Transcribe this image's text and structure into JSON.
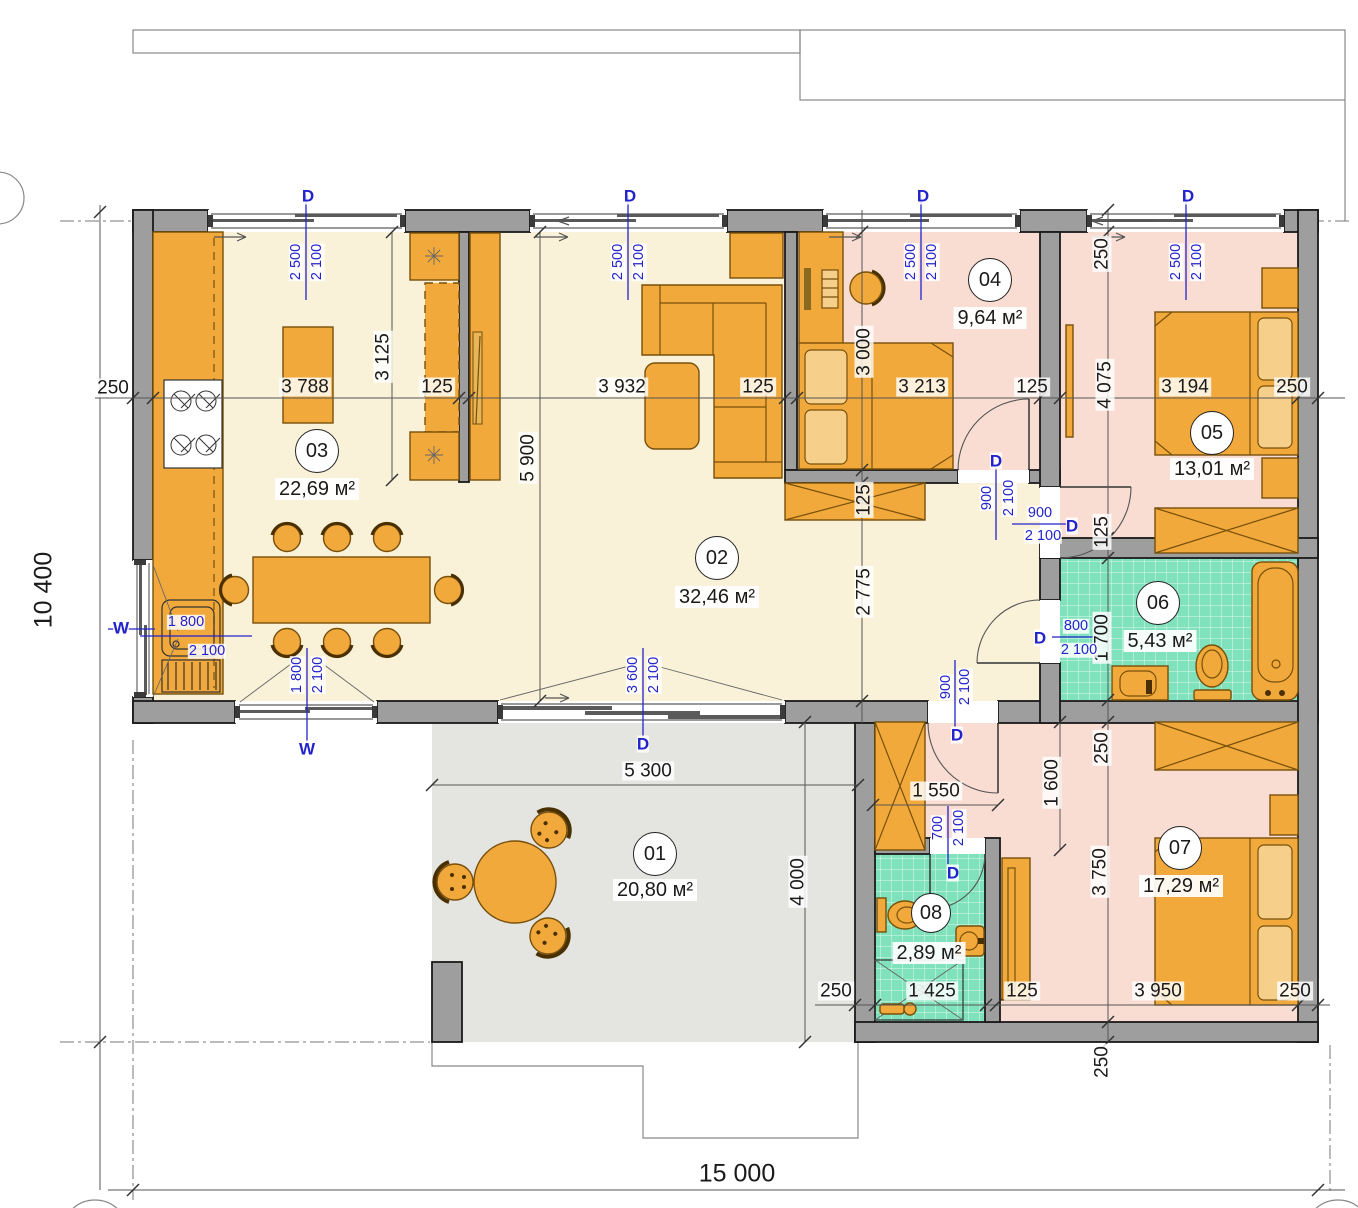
{
  "rooms": [
    {
      "num": "01",
      "area": "20,80 м²"
    },
    {
      "num": "02",
      "area": "32,46 м²"
    },
    {
      "num": "03",
      "area": "22,69 м²"
    },
    {
      "num": "04",
      "area": "9,64 м²"
    },
    {
      "num": "05",
      "area": "13,01 м²"
    },
    {
      "num": "06",
      "area": "5,43 м²"
    },
    {
      "num": "07",
      "area": "17,29 м²"
    },
    {
      "num": "08",
      "area": "2,89 м²"
    }
  ],
  "marks": {
    "door": "D",
    "window": "W"
  },
  "openings": {
    "win2500": {
      "w": "2 500",
      "h": "2 100"
    },
    "win1800": {
      "w": "1 800",
      "h": "2 100"
    },
    "slide3600": {
      "w": "3 600",
      "h": "2 100"
    },
    "door900": {
      "w": "900",
      "h": "2 100"
    },
    "door800": {
      "w": "800",
      "h": "2 100"
    },
    "door700": {
      "w": "700",
      "h": "2 100"
    }
  },
  "dims": {
    "c1": "250",
    "c2": "3 788",
    "c3": "125",
    "c4": "3 932",
    "c5": "125",
    "c6": "3 213",
    "c7": "125",
    "c8": "3 194",
    "c9": "250",
    "k3125": "3 125",
    "k5900": "5 900",
    "v3000": "3 000",
    "v125a": "125",
    "v2775": "2 775",
    "r250a": "250",
    "r4075": "4 075",
    "r125": "125",
    "r1700": "1 700",
    "r250b": "250",
    "r3750": "3 750",
    "r250c": "250",
    "t5300": "5 300",
    "t4000": "4 000",
    "h1550": "1 550",
    "h1600": "1 600",
    "b250a": "250",
    "b1425": "1 425",
    "b125": "125",
    "b3950": "3 950",
    "b250b": "250",
    "overall_w": "15 000",
    "overall_h": "10 400"
  }
}
